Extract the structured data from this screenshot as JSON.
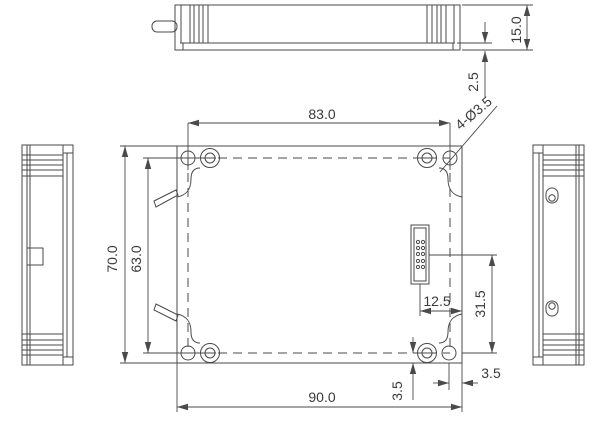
{
  "drawing": {
    "dimensions": {
      "hole_span_horizontal": "83.0",
      "body_thickness": "15.0",
      "flange_offset": "2.5",
      "mounting_holes_callout": "4-Ø3.5",
      "overall_height": "70.0",
      "hole_span_vertical": "63.0",
      "overall_width": "90.0",
      "connector_offset_horizontal": "12.5",
      "connector_offset_vertical": "31.5",
      "hole_edge_offset_bottom": "3.5",
      "hole_edge_offset_right": "3.5"
    }
  }
}
